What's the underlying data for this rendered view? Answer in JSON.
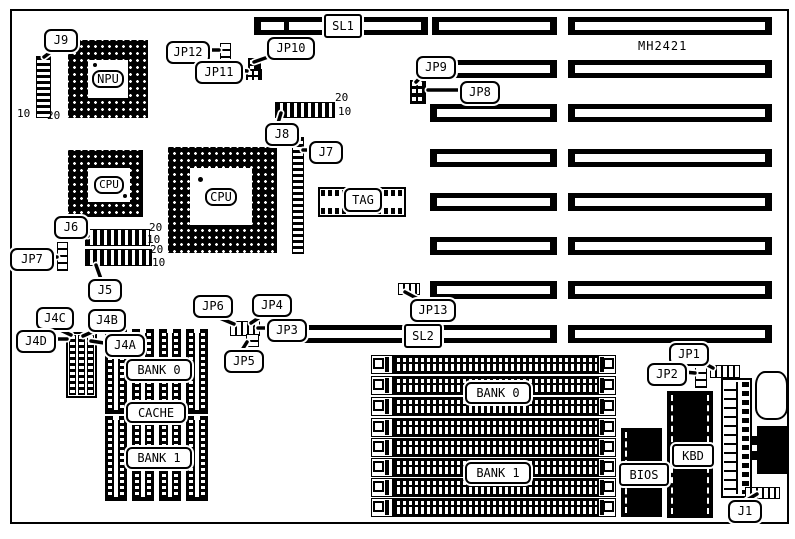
{
  "board": {
    "model": "MH2421"
  },
  "slots": {
    "sl1": "SL1",
    "sl2": "SL2"
  },
  "callouts": {
    "j9": "J9",
    "jp12": "JP12",
    "jp10": "JP10",
    "jp11": "JP11",
    "jp9": "JP9",
    "jp8": "JP8",
    "j8": "J8",
    "j7": "J7",
    "j6": "J6",
    "j5": "J5",
    "jp7": "JP7",
    "j4c": "J4C",
    "j4b": "J4B",
    "j4d": "J4D",
    "j4a": "J4A",
    "jp6": "JP6",
    "jp4": "JP4",
    "jp3": "JP3",
    "jp5": "JP5",
    "jp13": "JP13",
    "jp1": "JP1",
    "jp2": "JP2",
    "j1": "J1"
  },
  "chips": {
    "npu": "NPU",
    "cpu_small": "CPU",
    "cpu_large": "CPU",
    "tag": "TAG",
    "bios": "BIOS",
    "kbd": "KBD"
  },
  "memory": {
    "cache_bank0": "BANK 0",
    "cache": "CACHE",
    "cache_bank1": "BANK 1",
    "simm_bank0": "BANK 0",
    "simm_bank1": "BANK 1"
  },
  "pin_labels": {
    "j9_10": "10",
    "j9_20": "20",
    "j8_20": "20",
    "j8_10": "10",
    "j6_20": "20",
    "j6_10": "10",
    "j5_20": "20",
    "j5_10": "10"
  },
  "colors": {
    "ink": "#000000",
    "paper": "#ffffff"
  }
}
